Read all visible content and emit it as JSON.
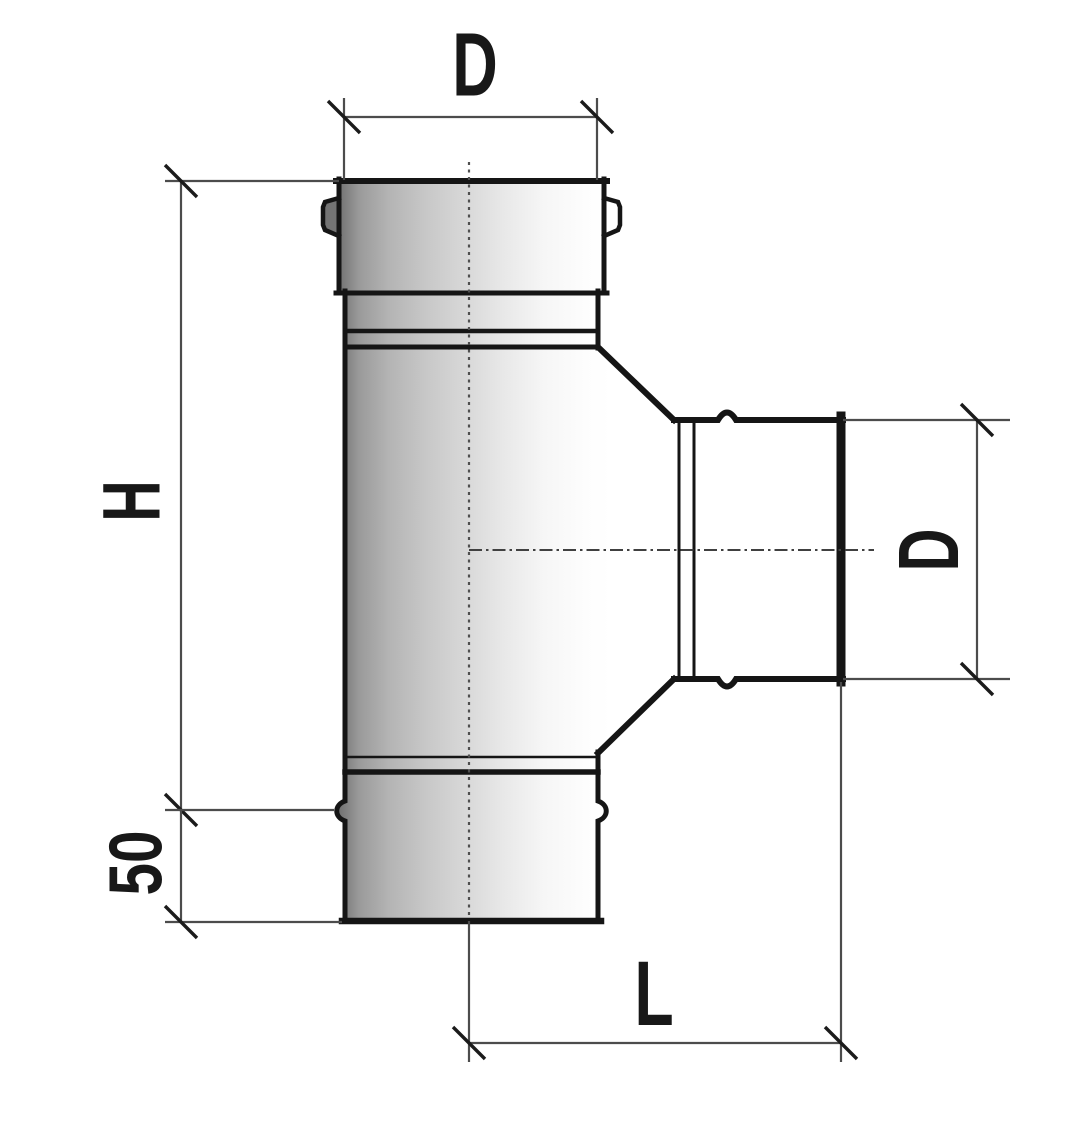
{
  "drawing": {
    "type": "technical-drawing-tee-pipe-fitting",
    "labels": {
      "top_diameter": "D",
      "body_height": "H",
      "socket_offset": "50",
      "branch_diameter": "D",
      "branch_length": "L"
    },
    "dimensions": [
      {
        "label": "D",
        "orientation": "horizontal",
        "location": "top"
      },
      {
        "label": "H",
        "orientation": "vertical",
        "location": "left"
      },
      {
        "label": "50",
        "orientation": "vertical",
        "location": "bottom-left"
      },
      {
        "label": "D",
        "orientation": "vertical",
        "location": "right-branch"
      },
      {
        "label": "L",
        "orientation": "horizontal",
        "location": "bottom"
      }
    ],
    "colors": {
      "background": "#ffffff",
      "outline": "#151515",
      "dimension_line": "#4c4c4c",
      "tick": "#1b1b1b",
      "centerline": "#4f4f4f",
      "text": "#181818",
      "shade_dark": "#747474",
      "shade_light": "#ffffff"
    }
  }
}
